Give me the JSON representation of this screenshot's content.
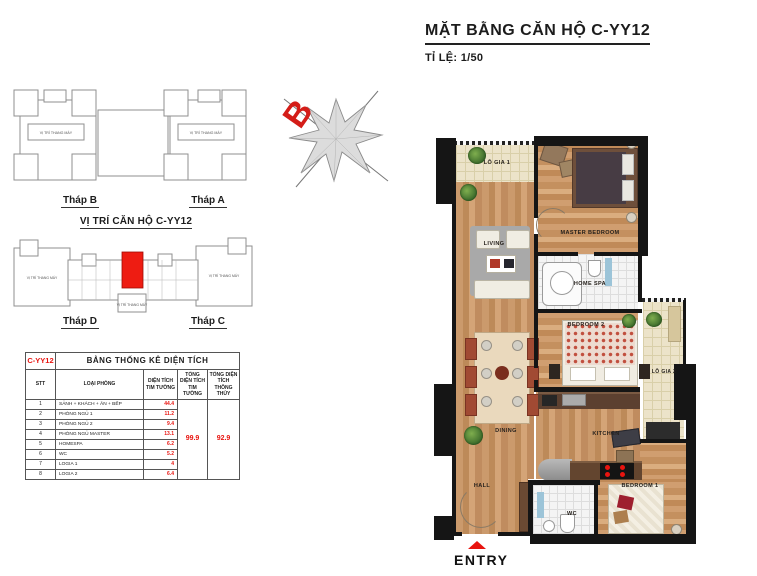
{
  "header": {
    "title": "MẶT BẰNG CĂN HỘ C-YY12",
    "scale_label": "TỈ LỆ: 1/50"
  },
  "compass": {
    "north_label": "B"
  },
  "towers_top": {
    "left_label": "Tháp B",
    "right_label": "Tháp A",
    "elevator_note": "VỊ TRÍ THANG MÁY"
  },
  "location": {
    "title": "VỊ TRÍ CĂN HỘ C-YY12",
    "left_label": "Tháp D",
    "right_label": "Tháp C",
    "elevator_note": "VỊ TRÍ THANG MÁY"
  },
  "area_table": {
    "unit_code": "C-YY12",
    "title": "BẢNG THỐNG KÊ DIỆN TÍCH",
    "columns": [
      "STT",
      "LOẠI PHÒNG",
      "DIỆN TÍCH TIM TƯỜNG",
      "TỔNG DIỆN TÍCH TIM TƯỜNG",
      "TỔNG DIỆN TÍCH THÔNG THỦY"
    ],
    "rows": [
      {
        "stt": "1",
        "room": "SẢNH + KHÁCH + ĂN + BẾP",
        "area": "44.4"
      },
      {
        "stt": "2",
        "room": "PHÒNG NGỦ 1",
        "area": "11.2"
      },
      {
        "stt": "3",
        "room": "PHÒNG NGỦ 2",
        "area": "9.4"
      },
      {
        "stt": "4",
        "room": "PHÒNG NGỦ MASTER",
        "area": "13.1"
      },
      {
        "stt": "5",
        "room": "HOMESPA",
        "area": "6.2"
      },
      {
        "stt": "6",
        "room": "WC",
        "area": "5.2"
      },
      {
        "stt": "7",
        "room": "LOGIA 1",
        "area": "4"
      },
      {
        "stt": "8",
        "room": "LOGIA 2",
        "area": "6.4"
      }
    ],
    "total_tim_tuong": "99.9",
    "total_thong_thuy": "92.9"
  },
  "floorplan": {
    "labels": {
      "logia1": "LÔ GIA 1",
      "living": "LIVING",
      "master_bedroom": "MASTER BEDROOM",
      "home_spa": "HOME SPA",
      "bedroom2": "BEDROOM 2",
      "logia2": "LÔ GIA 2",
      "dining": "DINING",
      "kitchen": "KITCHEN",
      "bedroom1": "BEDROOM 1",
      "hall": "HALL",
      "wc": "WC"
    },
    "entry_label": "ENTRY"
  },
  "colors": {
    "accent_red": "#e8140f",
    "wall_black": "#151515",
    "wood": "#c4905f",
    "balcony_tile": "#ece3c9"
  }
}
